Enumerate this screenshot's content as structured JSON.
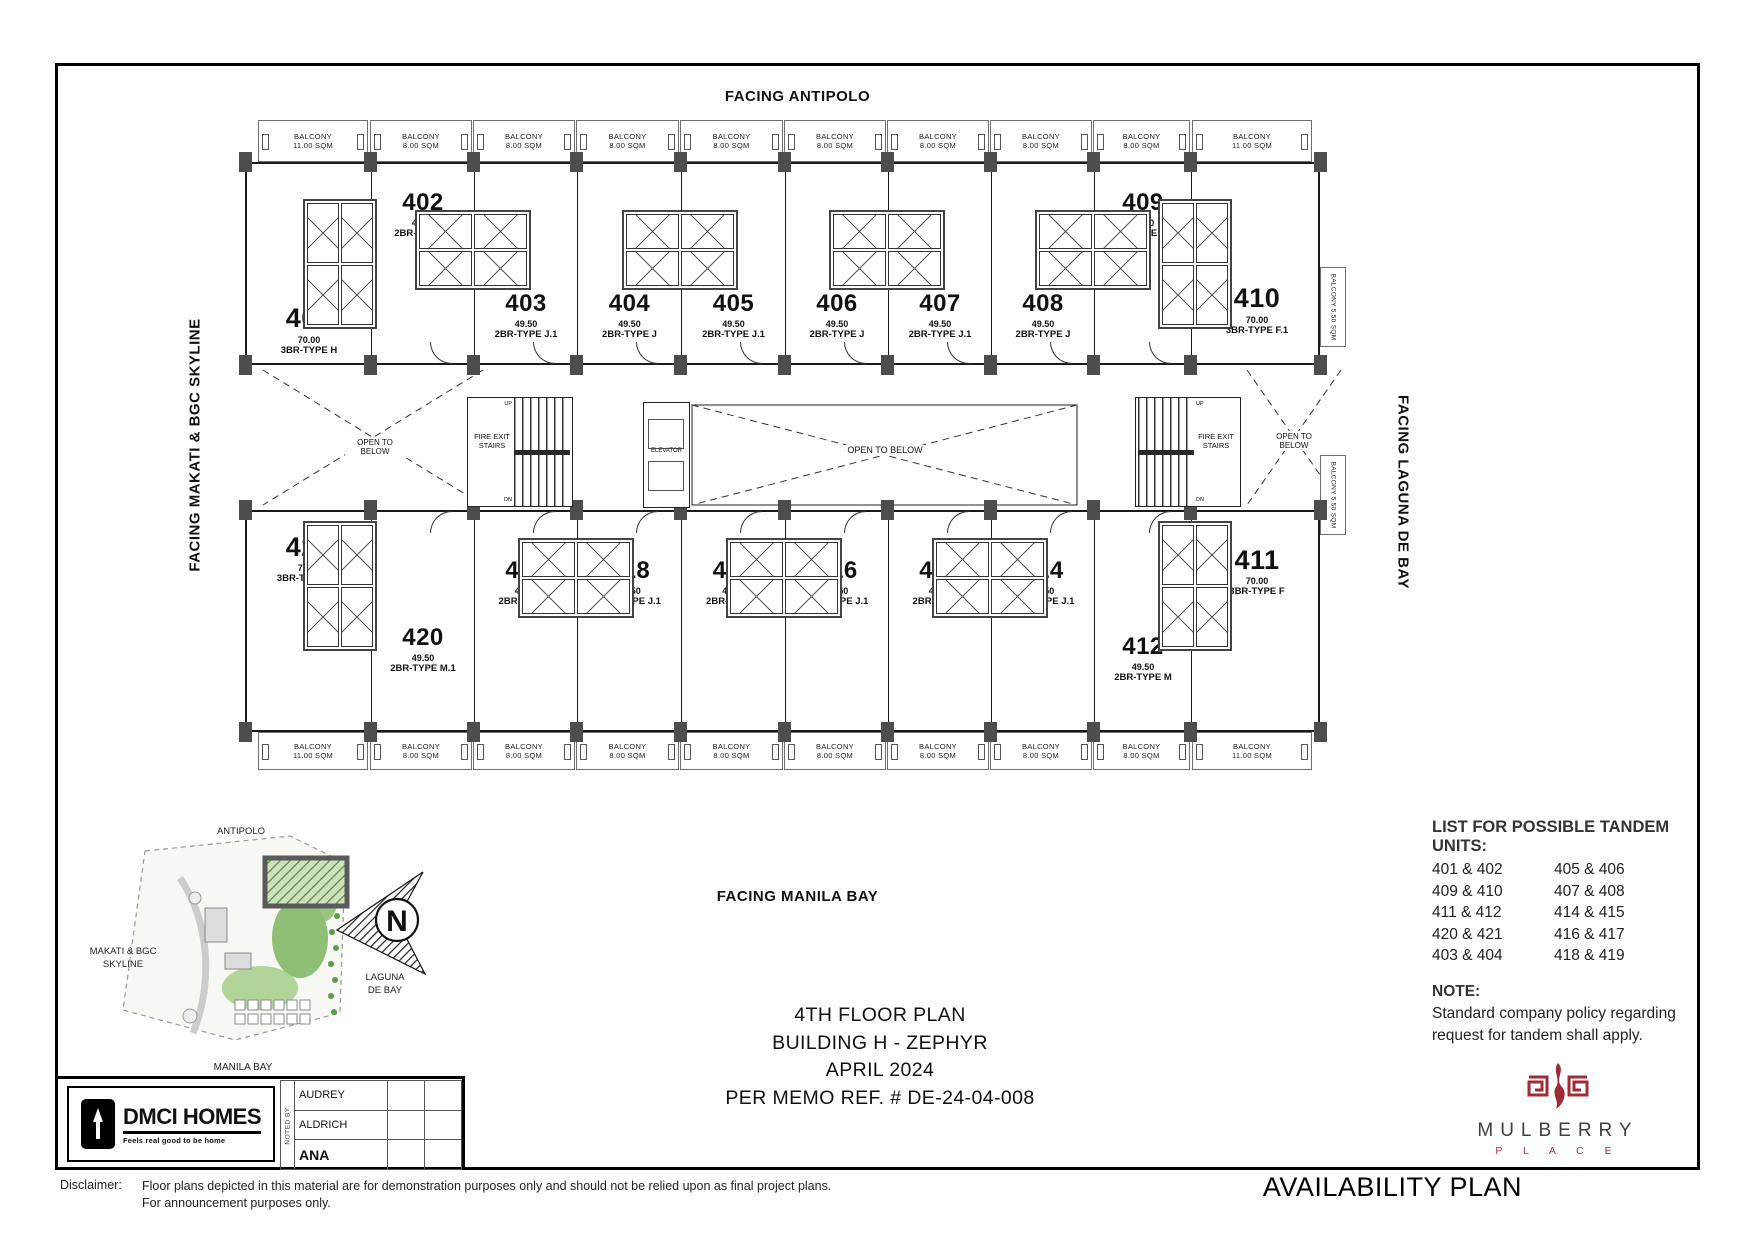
{
  "sheet": {
    "facing_top": "FACING ANTIPOLO",
    "facing_left": "FACING MAKATI & BGC SKYLINE",
    "facing_right": "FACING LAGUNA DE BAY",
    "facing_bottom": "FACING MANILA BAY"
  },
  "plan": {
    "top_balconies": [
      {
        "name": "BALCONY",
        "area": "11.00 SQM"
      },
      {
        "name": "BALCONY",
        "area": "8.00 SQM"
      },
      {
        "name": "BALCONY",
        "area": "8.00 SQM"
      },
      {
        "name": "BALCONY",
        "area": "8.00 SQM"
      },
      {
        "name": "BALCONY",
        "area": "8.00 SQM"
      },
      {
        "name": "BALCONY",
        "area": "8.00 SQM"
      },
      {
        "name": "BALCONY",
        "area": "8.00 SQM"
      },
      {
        "name": "BALCONY",
        "area": "8.00 SQM"
      },
      {
        "name": "BALCONY",
        "area": "8.00 SQM"
      },
      {
        "name": "BALCONY",
        "area": "11.00 SQM"
      }
    ],
    "bottom_balconies": [
      {
        "name": "BALCONY",
        "area": "11.00 SQM"
      },
      {
        "name": "BALCONY",
        "area": "8.00 SQM"
      },
      {
        "name": "BALCONY",
        "area": "8.00 SQM"
      },
      {
        "name": "BALCONY",
        "area": "8.00 SQM"
      },
      {
        "name": "BALCONY",
        "area": "8.00 SQM"
      },
      {
        "name": "BALCONY",
        "area": "8.00 SQM"
      },
      {
        "name": "BALCONY",
        "area": "8.00 SQM"
      },
      {
        "name": "BALCONY",
        "area": "8.00 SQM"
      },
      {
        "name": "BALCONY",
        "area": "8.00 SQM"
      },
      {
        "name": "BALCONY",
        "area": "11.00 SQM"
      }
    ],
    "side_balconies": [
      {
        "label": "BALCONY 5.50 SQM"
      },
      {
        "label": "BALCONY 5.50 SQM"
      }
    ],
    "top_units": [
      {
        "number": "401",
        "area": "70.00",
        "type": "3BR-TYPE H"
      },
      {
        "number": "402",
        "area": "49.50",
        "type": "2BR-TYPE M"
      },
      {
        "number": "403",
        "area": "49.50",
        "type": "2BR-TYPE J.1"
      },
      {
        "number": "404",
        "area": "49.50",
        "type": "2BR-TYPE J"
      },
      {
        "number": "405",
        "area": "49.50",
        "type": "2BR-TYPE J.1"
      },
      {
        "number": "406",
        "area": "49.50",
        "type": "2BR-TYPE J"
      },
      {
        "number": "407",
        "area": "49.50",
        "type": "2BR-TYPE J.1"
      },
      {
        "number": "408",
        "area": "49.50",
        "type": "2BR-TYPE J"
      },
      {
        "number": "409",
        "area": "49.50",
        "type": "2BR-TYPE M.1"
      },
      {
        "number": "410",
        "area": "70.00",
        "type": "3BR-TYPE F.1"
      }
    ],
    "bottom_units": [
      {
        "number": "421",
        "area": "70.00",
        "type": "3BR-TYPE H.1"
      },
      {
        "number": "420",
        "area": "49.50",
        "type": "2BR-TYPE M.1"
      },
      {
        "number": "419",
        "area": "49.50",
        "type": "2BR-TYPE J"
      },
      {
        "number": "418",
        "area": "49.50",
        "type": "2BR-TYPE J.1"
      },
      {
        "number": "417",
        "area": "49.50",
        "type": "2BR-TYPE J"
      },
      {
        "number": "416",
        "area": "49.50",
        "type": "2BR-TYPE J.1"
      },
      {
        "number": "415",
        "area": "49.50",
        "type": "2BR-TYPE J"
      },
      {
        "number": "414",
        "area": "49.50",
        "type": "2BR-TYPE J.1"
      },
      {
        "number": "412",
        "area": "49.50",
        "type": "2BR-TYPE M"
      },
      {
        "number": "411",
        "area": "70.00",
        "type": "3BR-TYPE F"
      }
    ],
    "core": {
      "fire_exit_stairs": "FIRE EXIT STAIRS",
      "elevator": "ELEVATOR",
      "open_to_below": "OPEN TO BELOW",
      "up": "UP",
      "dn": "DN"
    }
  },
  "site_map": {
    "top": "ANTIPOLO",
    "left_line1": "MAKATI & BGC",
    "left_line2": "SKYLINE",
    "right_line1": "LAGUNA",
    "right_line2": "DE BAY",
    "bottom": "MANILA BAY",
    "compass": "N"
  },
  "title_block": {
    "line1": "4TH FLOOR PLAN",
    "line2": "BUILDING H - ZEPHYR",
    "line3": "APRIL 2024",
    "line4": "PER MEMO REF. # DE-24-04-008"
  },
  "tandem": {
    "title": "LIST FOR POSSIBLE TANDEM",
    "subtitle": "UNITS:",
    "col1": [
      "401 & 402",
      "409 & 410",
      "411 & 412",
      "420 & 421",
      "403 & 404"
    ],
    "col2": [
      "405 & 406",
      "407 & 408",
      "414 & 415",
      "416 & 417",
      "418 & 419"
    ]
  },
  "note": {
    "title": "NOTE:",
    "line1": "Standard company policy regarding",
    "line2": "request for tandem shall apply."
  },
  "branding": {
    "dmci_name": "DMCI HOMES",
    "dmci_tagline": "Feels real good to be home",
    "mulberry_name": "MULBERRY",
    "mulberry_sub": "P L A C E",
    "mulberry_red": "#9e2b36"
  },
  "noted_by": {
    "label": "NOTED BY:",
    "names": [
      "AUDREY",
      "ALDRICH",
      "ANA"
    ]
  },
  "disclaimer": {
    "label": "Disclaimer:",
    "line1": "Floor plans depicted in this material are for demonstration purposes only and should not be relied upon as final project plans.",
    "line2": "For announcement purposes only."
  },
  "footer": {
    "plan_type": "AVAILABILITY PLAN"
  }
}
